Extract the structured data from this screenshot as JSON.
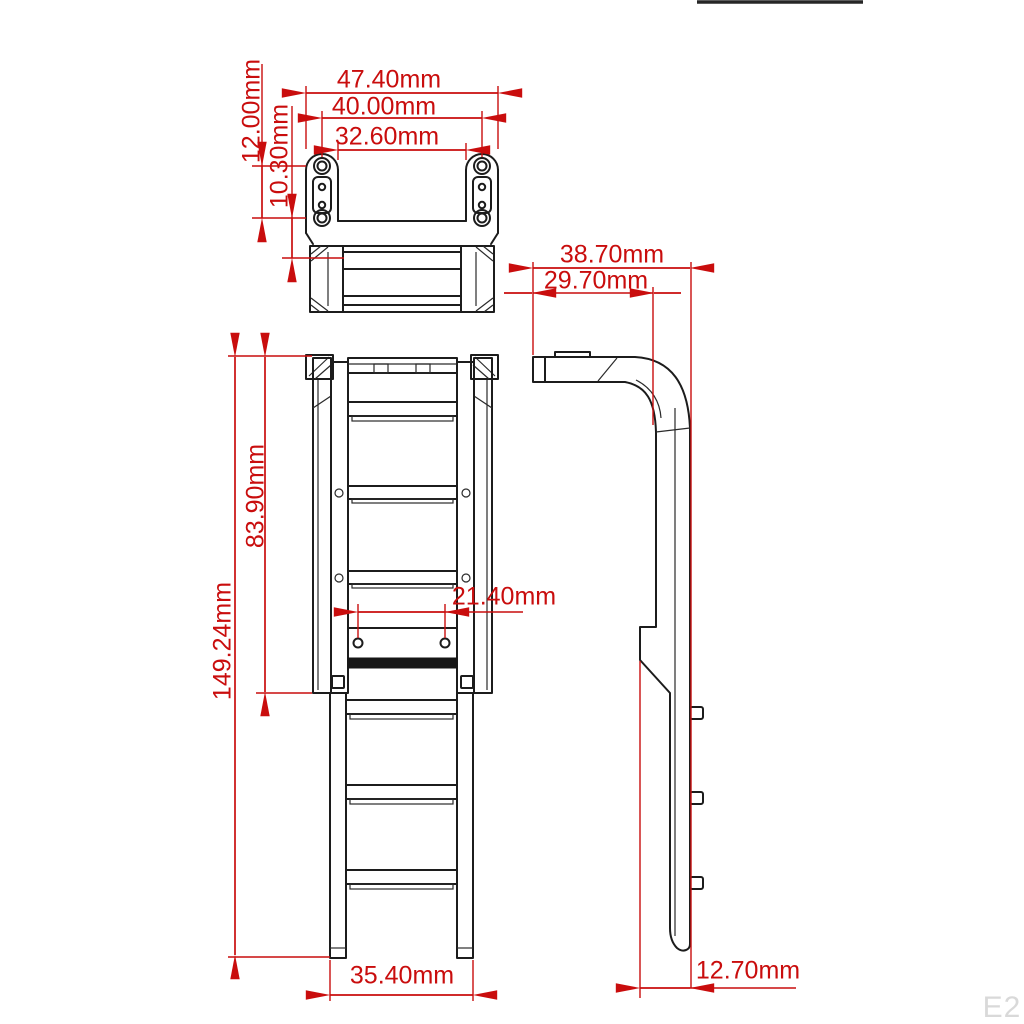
{
  "drawing_type": "technical dimension drawing (ladder accessory, three views)",
  "unit": "mm",
  "colors": {
    "background": "#ffffff",
    "outline_black": "#1c1c1c",
    "dimension_red": "#c90d0d",
    "watermark_gray": "#d9d9d9"
  },
  "dims": {
    "d47_40": {
      "label": "47.40mm",
      "value": 47.4,
      "orientation": "horizontal",
      "view": "top"
    },
    "d40_00": {
      "label": "40.00mm",
      "value": 40.0,
      "orientation": "horizontal",
      "view": "top"
    },
    "d32_60": {
      "label": "32.60mm",
      "value": 32.6,
      "orientation": "horizontal",
      "view": "top"
    },
    "d12_00": {
      "label": "12.00mm",
      "value": 12.0,
      "orientation": "vertical",
      "view": "top"
    },
    "d10_30": {
      "label": "10.30mm",
      "value": 10.3,
      "orientation": "vertical",
      "view": "top"
    },
    "d38_70": {
      "label": "38.70mm",
      "value": 38.7,
      "orientation": "horizontal",
      "view": "side"
    },
    "d29_70": {
      "label": "29.70mm",
      "value": 29.7,
      "orientation": "horizontal",
      "view": "side"
    },
    "d149_24": {
      "label": "149.24mm",
      "value": 149.24,
      "orientation": "vertical",
      "view": "front"
    },
    "d83_90": {
      "label": "83.90mm",
      "value": 83.9,
      "orientation": "vertical",
      "view": "front"
    },
    "d21_40": {
      "label": "21.40mm",
      "value": 21.4,
      "orientation": "horizontal",
      "view": "front"
    },
    "d35_40": {
      "label": "35.40mm",
      "value": 35.4,
      "orientation": "horizontal",
      "view": "front"
    },
    "d12_70": {
      "label": "12.70mm",
      "value": 12.7,
      "orientation": "horizontal",
      "view": "side"
    }
  },
  "watermark": {
    "label": "E2"
  }
}
